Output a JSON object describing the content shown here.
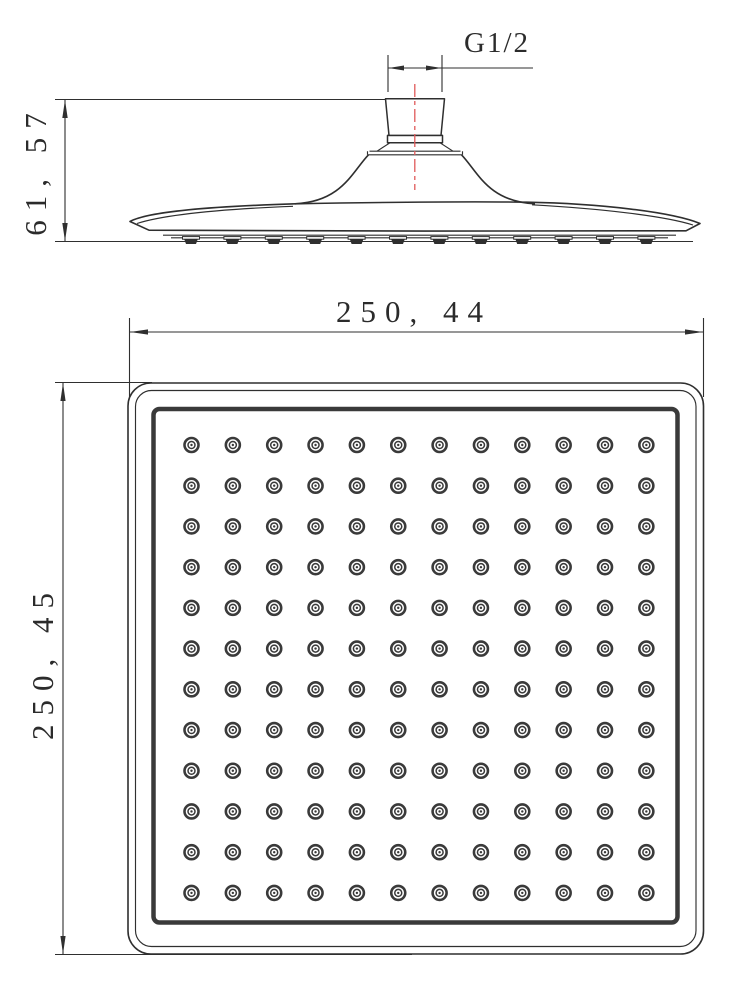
{
  "drawing": {
    "subject": "square-rain-shower-head",
    "views": {
      "side": {
        "name": "side-elevation",
        "thread_label": "G1/2",
        "height_label": "61, 57",
        "nozzle_tab_count": 12
      },
      "plan": {
        "name": "bottom-plan",
        "width_label": "250, 44",
        "height_label": "250, 45",
        "nozzle_rows": 12,
        "nozzle_cols": 12,
        "nozzle_total": 144
      }
    },
    "colors": {
      "line": "#2f2f2f",
      "plate_line": "#3a3a3a",
      "centerline": "#e05a5a",
      "background": "#ffffff"
    }
  }
}
